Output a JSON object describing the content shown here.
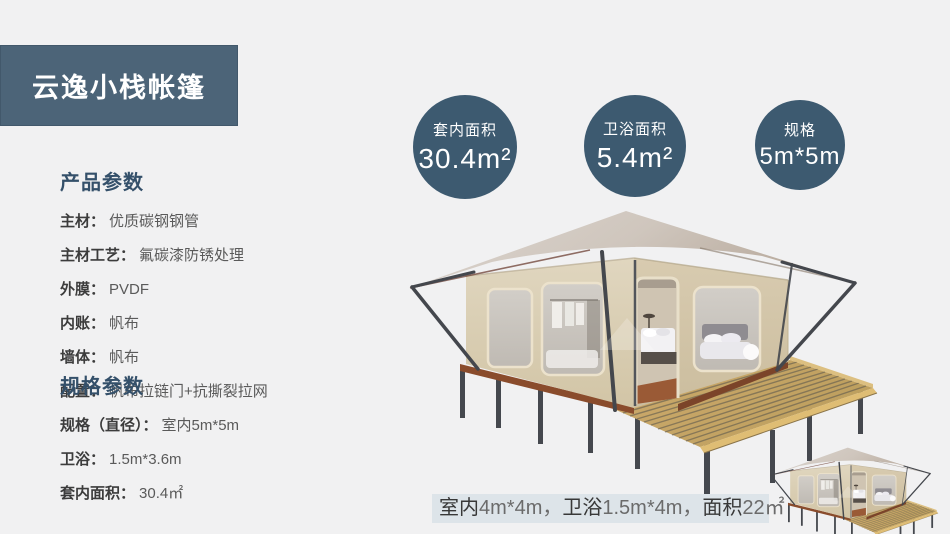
{
  "header": {
    "title": "云逸小栈帐篷"
  },
  "badges": [
    {
      "label": "套内面积",
      "value": "30.4m²"
    },
    {
      "label": "卫浴面积",
      "value": "5.4m²"
    },
    {
      "label": "规格",
      "value": "5m*5m"
    }
  ],
  "sidebar": {
    "product_params": {
      "title": "产品参数",
      "rows": [
        {
          "label": "主材：",
          "value": "优质碳钢钢管"
        },
        {
          "label": "主材工艺：",
          "value": "氟碳漆防锈处理"
        },
        {
          "label": "外膜：",
          "value": "PVDF"
        },
        {
          "label": "内账：",
          "value": "帆布"
        },
        {
          "label": "墙体：",
          "value": "帆布"
        },
        {
          "label": "配置：",
          "value": "帆布拉链门+抗撕裂拉网"
        }
      ]
    },
    "spec_params": {
      "title": "规格参数",
      "rows": [
        {
          "label": "规格（直径）：",
          "value": "室内5m*5m"
        },
        {
          "label": "卫浴：",
          "value": "1.5m*3.6m"
        },
        {
          "label": "套内面积：",
          "value": "30.4㎡"
        }
      ]
    }
  },
  "caption": {
    "segments": [
      {
        "label": "室内",
        "value": "4m*4m，"
      },
      {
        "label": "卫浴",
        "value": "1.5m*4m，"
      },
      {
        "label": "面积",
        "value": "22㎡"
      }
    ]
  },
  "colors": {
    "accent": "#3d5a70",
    "header_bg": "#4c6478",
    "caption_bg": "#dde4e9",
    "page_bg": "#f1f1f2"
  }
}
